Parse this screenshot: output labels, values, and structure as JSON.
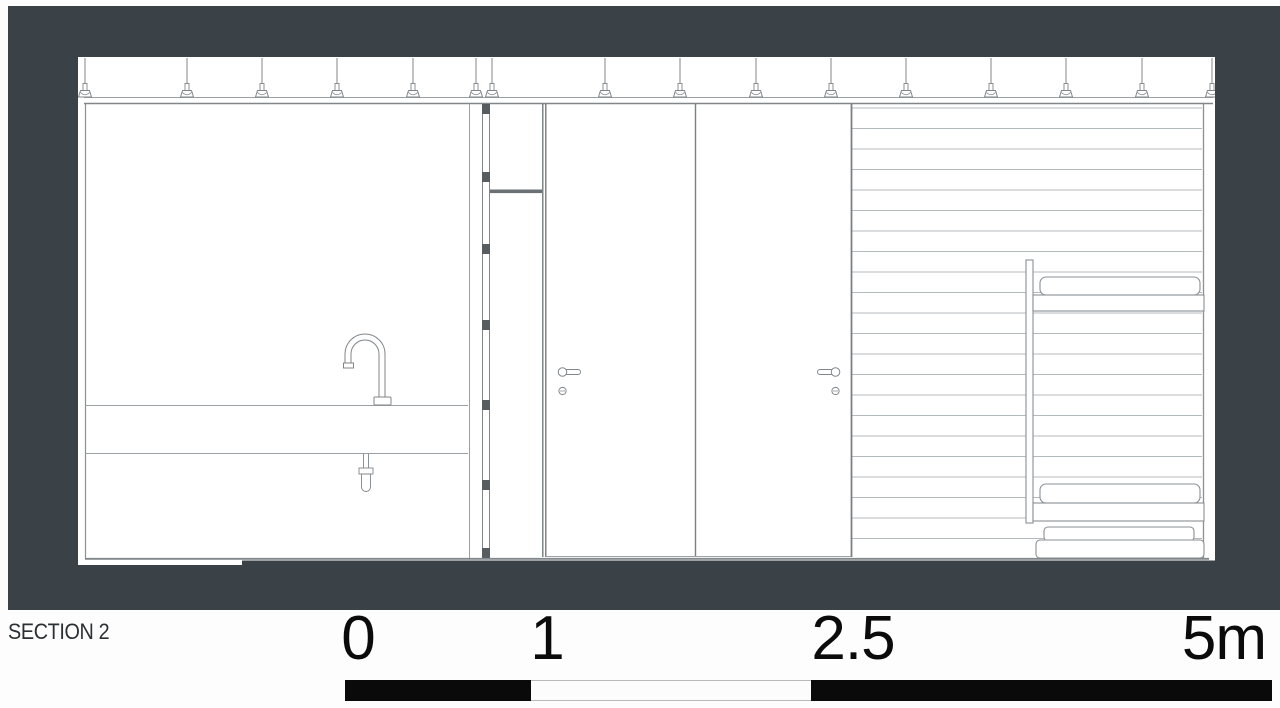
{
  "drawing": {
    "label": "SECTION 2",
    "type": "architectural-section",
    "elements": {
      "hanger_positions": [
        7,
        109,
        184,
        259,
        335,
        398,
        414,
        527,
        602,
        678,
        753,
        828,
        913,
        988,
        1064,
        1134
      ],
      "stud_positions_y": [
        47,
        115,
        187,
        263,
        343,
        423,
        491
      ],
      "siding": {
        "x1": 774,
        "x2": 1124,
        "y_first": 51,
        "spacing": 20.5,
        "count": 22
      }
    }
  },
  "scale_bar": {
    "labels": [
      "0",
      "1",
      "2.5",
      "5m"
    ],
    "unit": "m",
    "max_meters": 5,
    "segments": [
      {
        "from": 0,
        "to": 1,
        "fill": "black"
      },
      {
        "from": 1,
        "to": 2.5,
        "fill": "white"
      },
      {
        "from": 2.5,
        "to": 5,
        "fill": "black"
      }
    ]
  },
  "colors": {
    "background": "#3a4147",
    "paper": "#ffffff",
    "line_light": "#b5babd",
    "line": "#9aa0a4",
    "line_mid": "#8a9094",
    "line_dark": "#7a8084",
    "fitting": "#80868a",
    "stud": "#565c60",
    "shelf": "#6a7074",
    "bar_black": "#0a0a0a",
    "label_text": "#2b3034"
  }
}
